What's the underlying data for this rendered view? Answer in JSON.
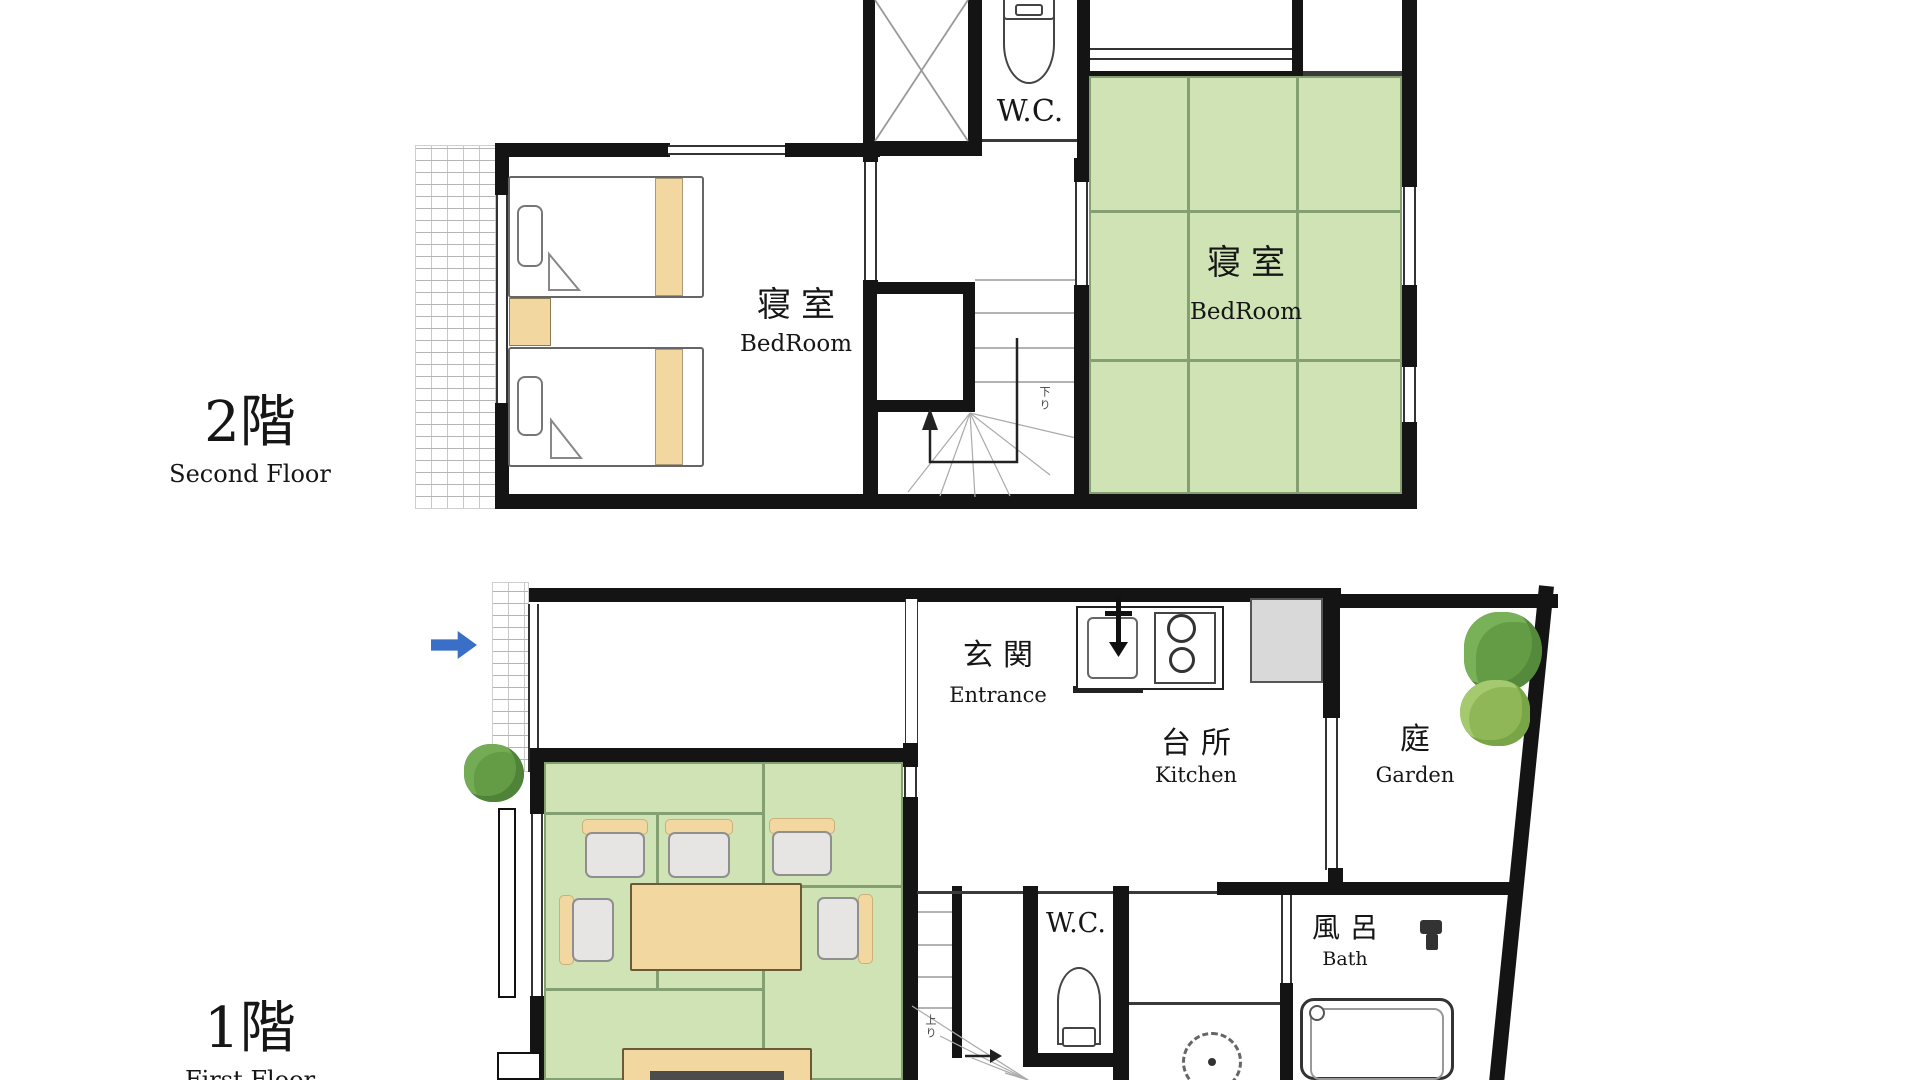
{
  "title": "House floor plan (2-storey Japanese house)",
  "colors": {
    "wall": "#141414",
    "tatami": "#cfe3b4",
    "tatami_line": "#84a072",
    "wood": "#f2d7a0",
    "chair": "#e7e5e3",
    "arrow_blue": "#3a6fc7",
    "tree_dark": "#649c46",
    "tree_light": "#8fb757"
  },
  "floor2": {
    "name_jp": "2階",
    "name_en": "Second Floor",
    "wc_label": "W.C.",
    "bedroom_west": {
      "jp": "寝室",
      "en": "BedRoom"
    },
    "bedroom_east": {
      "jp": "寝室",
      "en": "BedRoom"
    },
    "stairs_note": "下り"
  },
  "floor1": {
    "name_jp": "1階",
    "name_en": "First Floor",
    "entrance": {
      "jp": "玄関",
      "en": "Entrance"
    },
    "kitchen": {
      "jp": "台所",
      "en": "Kitchen"
    },
    "garden": {
      "jp": "庭",
      "en": "Garden"
    },
    "wc_label": "W.C.",
    "bath": {
      "jp": "風呂",
      "en": "Bath"
    },
    "stairs_note": "上り"
  }
}
